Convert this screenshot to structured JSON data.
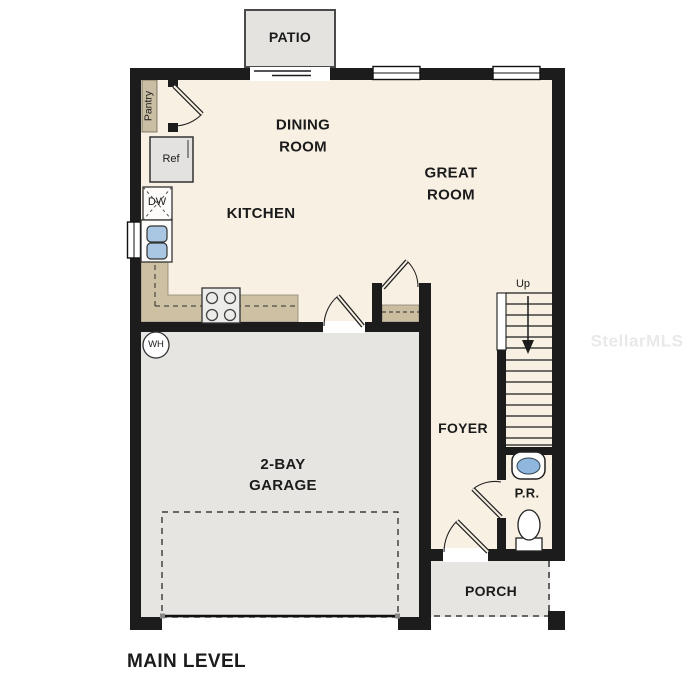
{
  "title": "MAIN LEVEL",
  "watermark": "StellarMLS",
  "rooms": {
    "patio": "PATIO",
    "dining": {
      "line1": "DINING",
      "line2": "ROOM"
    },
    "kitchen": "KITCHEN",
    "great": {
      "line1": "GREAT",
      "line2": "ROOM"
    },
    "garage": {
      "line1": "2-BAY",
      "line2": "GARAGE"
    },
    "foyer": "FOYER",
    "powder_room": "P.R.",
    "porch": "PORCH"
  },
  "fixtures": {
    "pantry": "Pantry",
    "refrigerator": "Ref",
    "dishwasher": "DW",
    "water_heater": "WH",
    "stairs_direction": "Up"
  },
  "colors": {
    "wall": "#1c1c1c",
    "floor": "#f7f0e3",
    "garage_floor": "#e6e5e2",
    "counter_tan": "#cec1a3",
    "sink_blue": "#a9c6e2",
    "watermark_gray": "#e9e9e9"
  }
}
